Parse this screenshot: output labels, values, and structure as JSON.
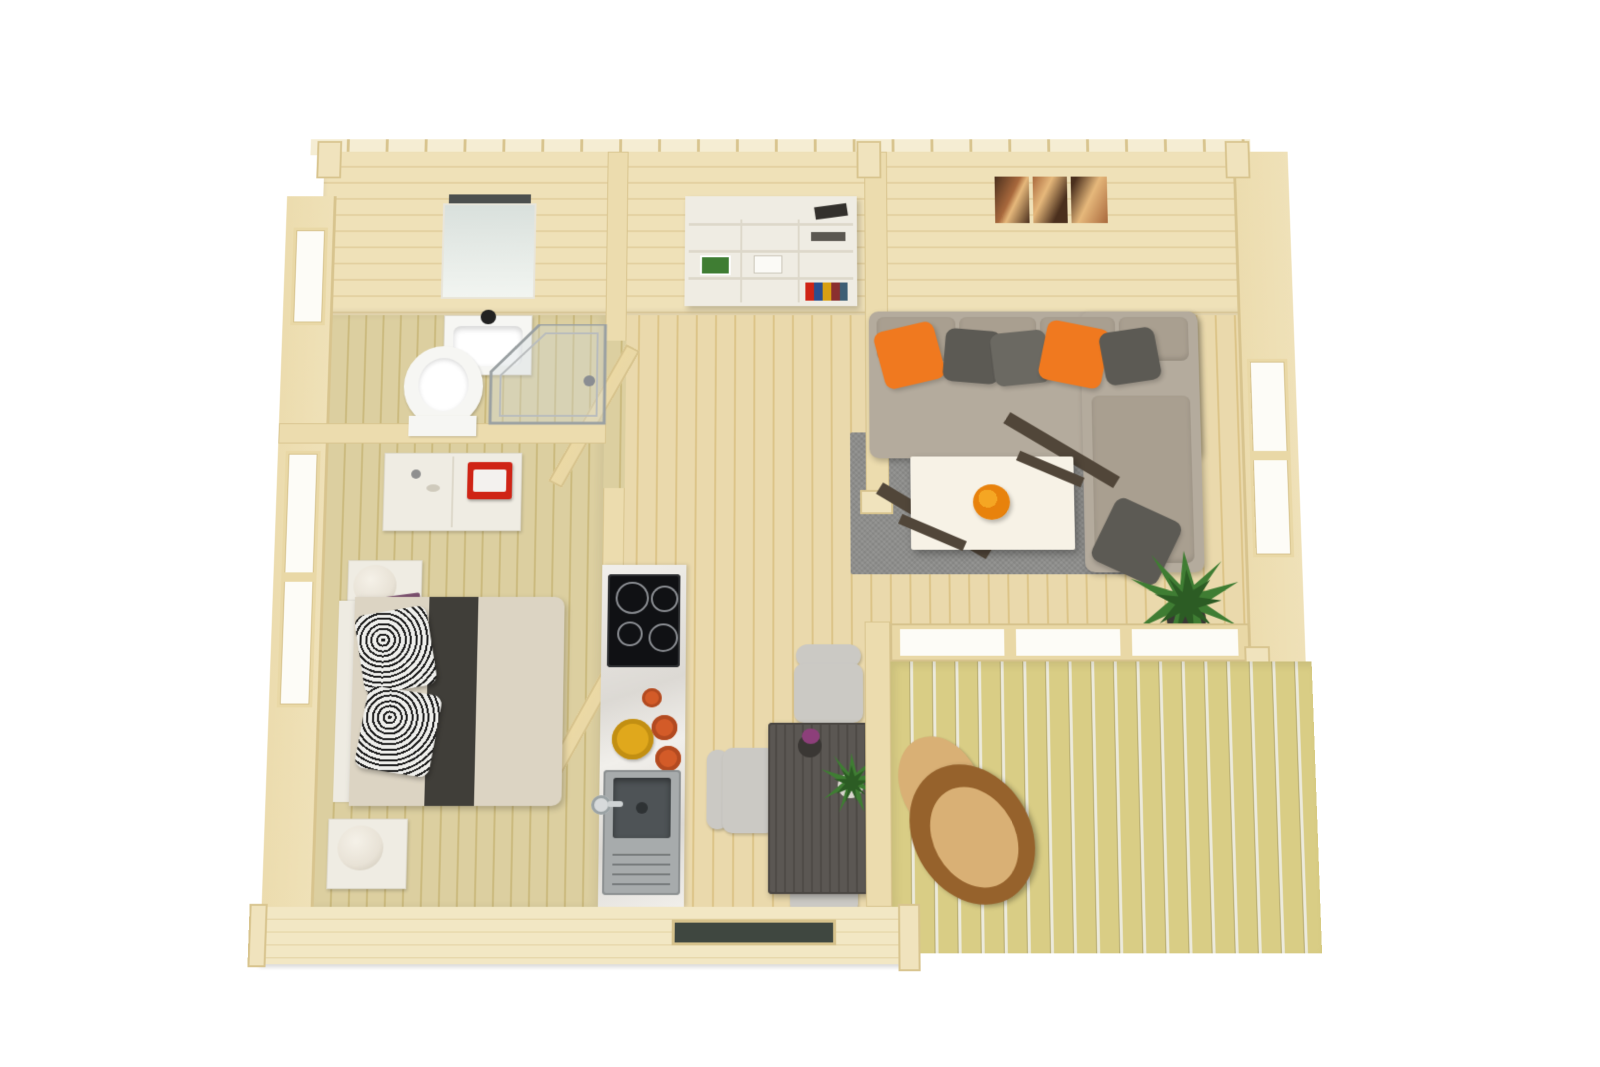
{
  "scene": {
    "description": "Top-down 3D floor plan rendering of a one-bedroom log cabin with bathroom, bedroom, hallway, kitchen, dining area, living room and a wooden terrace",
    "rooms": [
      {
        "name": "bathroom",
        "items": [
          "wall-mirror",
          "washbasin",
          "toilet",
          "corner-shower",
          "small-window"
        ]
      },
      {
        "name": "bedroom",
        "items": [
          "dresser",
          "red-storage-box",
          "nightstand-with-lamp",
          "magazine",
          "double-bed",
          "dark-bed-runner",
          "patterned-pillow",
          "patterned-pillow",
          "second-nightstand-with-lamp",
          "tall-window"
        ]
      },
      {
        "name": "hallway",
        "items": [
          "white-shelving-unit",
          "books",
          "open-interior-door",
          "open-interior-door"
        ]
      },
      {
        "name": "kitchen",
        "items": [
          "marble-worktop",
          "induction-hob",
          "orange-vase",
          "yellow-bowl",
          "orange-cups",
          "steel-sink-with-drainer",
          "faucet",
          "slit-window"
        ]
      },
      {
        "name": "dining-area",
        "items": [
          "dark-dining-table",
          "white-chair",
          "white-chair",
          "white-chair",
          "potted-flower",
          "potted-plant"
        ]
      },
      {
        "name": "living-room",
        "items": [
          "l-shaped-corner-sofa",
          "orange-cushion",
          "grey-cushion",
          "grey-cushion",
          "orange-cushion",
          "grey-cushion",
          "chaise-grey-cushion",
          "wall-art-triptych",
          "grey-rug",
          "white-coffee-table",
          "orange-flower-bouquet",
          "potted-palm",
          "window",
          "glass-wall-to-terrace"
        ]
      },
      {
        "name": "terrace",
        "items": [
          "wooden-deck",
          "wooden-lounge-chair-with-cushions"
        ]
      }
    ]
  },
  "palette": {
    "bg": "#ffffff",
    "roofEdge": "#f5edd3",
    "wallFace": "#efe1b8",
    "wallLine": "#e3d0a0",
    "wallSide": "#ecdcae",
    "logWall": "#f2e7c4",
    "logLine": "#e2d2a2",
    "post": "#f0e3bd",
    "postBorder": "#d8c48e",
    "floorHall": "#ead9ac",
    "floorHallLine": "#dcc488",
    "floorBed": "#dccfa0",
    "floorBedLine": "#cbba7e",
    "deck": "#d9cd85",
    "deckLine": "#b5aa6e",
    "deckGap": "#eceadb",
    "glass": "#fdfcf7",
    "frame": "#e9d8a6",
    "frameDark": "#d6c28c",
    "doorWood": "#ecd9a4",
    "steel": "#9aa0a2",
    "porcelain": "#f6f6f3",
    "mirror": "#d9e0dc",
    "sofa": "#b4ab9d",
    "sofaCushion": "#a99f90",
    "cushionDark": "#5c5a54",
    "orange": "#f0791f",
    "rug": "#8d8d8b",
    "tableTop": "#f7f2e6",
    "tableLeg": "#514639",
    "flowerOrange": "#e8820c",
    "flowerDark": "#b05a0a",
    "bedDuvet": "#dcd4c3",
    "bedRunner": "#403e39",
    "headboard": "#eeebe2",
    "pillowB": "#1c1c1c",
    "pillowW": "#efefec",
    "furnWhite": "#efece3",
    "furnWhiteSide": "#ddd8ca",
    "lamp": "#e8e2d6",
    "red": "#cf2415",
    "magazine": "#7a4f6d",
    "magazineGold": "#c9a24a",
    "cooktop": "#101114",
    "ring": "#8a8d92",
    "marble": "#f1efeb",
    "marbleVein": "#dcd9d4",
    "sinkSteel": "#a7abac",
    "sinkDark": "#4e5356",
    "yellow": "#e0a81c",
    "orangeCup": "#d35b28",
    "diningTable": "#5b5753",
    "diningGrain": "#4e4a46",
    "chair": "#cbc9c4",
    "green": "#3f7d33",
    "greenDark": "#2c5c24",
    "pot": "#3a3734",
    "purple": "#8d3f7a",
    "woodChair": "#96622c",
    "chairCushion": "#d9b075",
    "art1": "#a8683c",
    "artDark": "#4a2f1d",
    "bookBlue": "#2b4f8e",
    "bookGold": "#d8a012"
  }
}
